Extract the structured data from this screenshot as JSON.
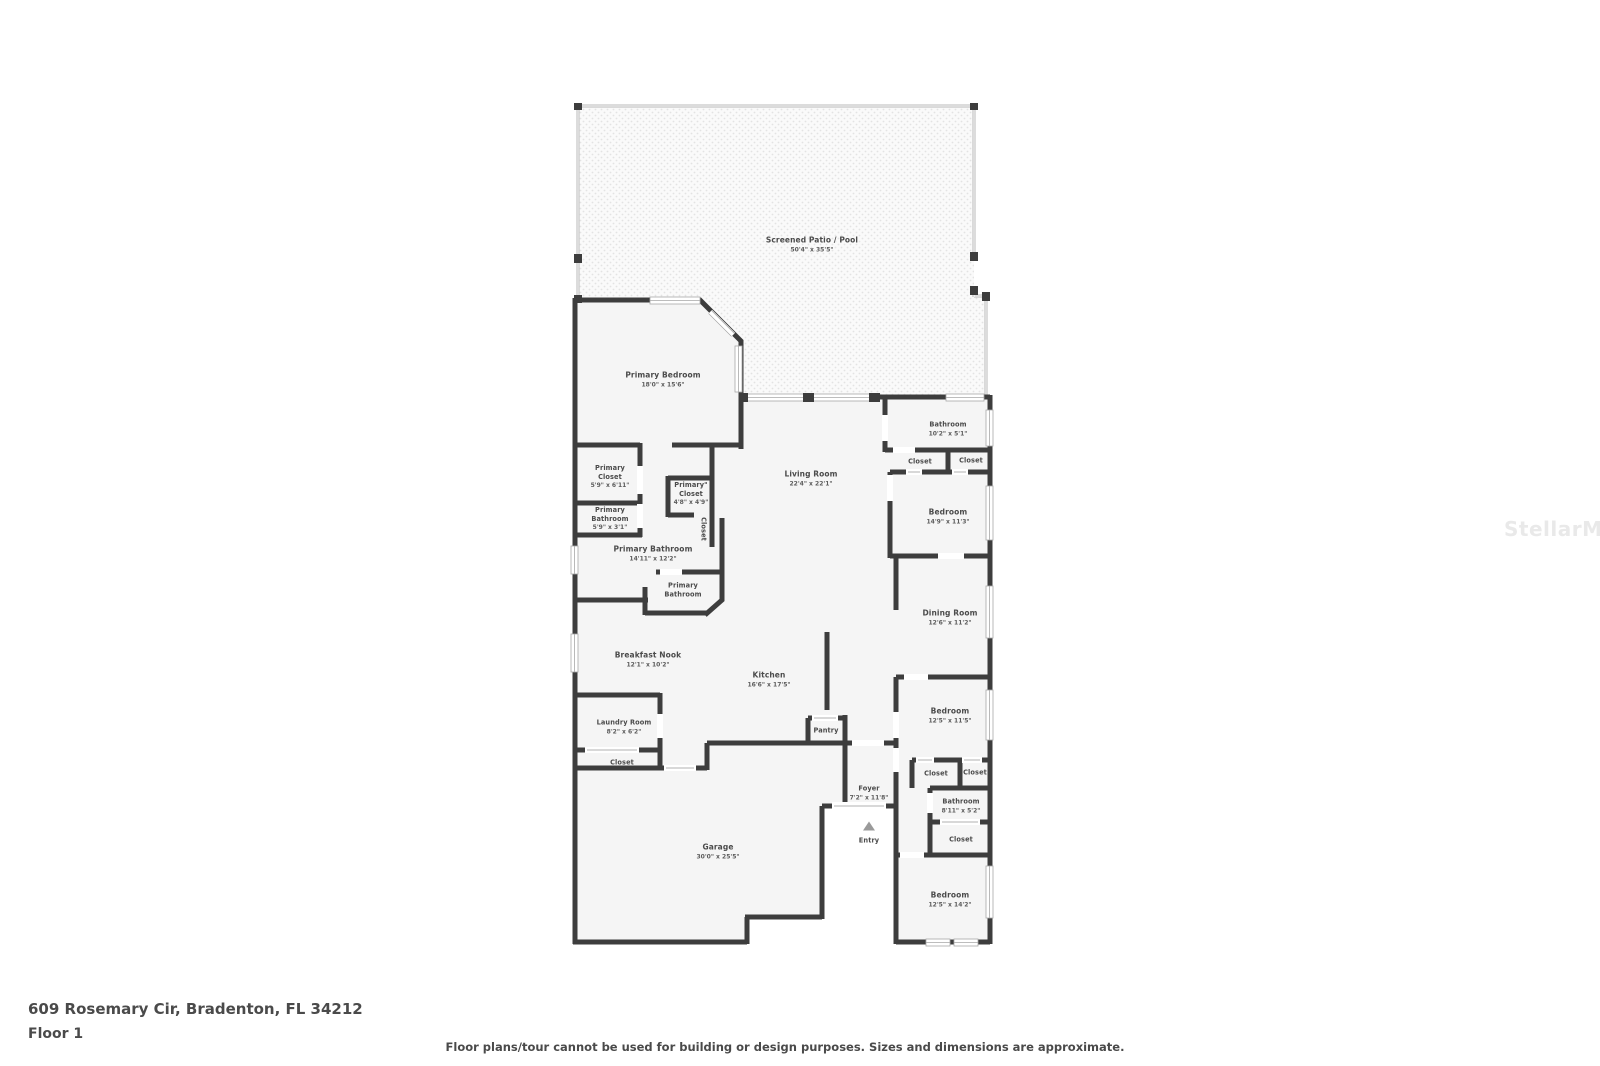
{
  "address": "609 Rosemary Cir, Bradenton, FL 34212",
  "floor_label": "Floor 1",
  "disclaimer": "Floor plans/tour cannot be used for building or design purposes. Sizes and dimensions are approximate.",
  "watermark": "StellarMLS",
  "colors": {
    "wall": "#3d3d3d",
    "room_fill": "#f5f5f5",
    "label_text": "#4b4b4b",
    "watermark": "#e9e9e9"
  },
  "rooms": [
    {
      "label": "Screened Patio / Pool",
      "dims": "50'4\" x 35'5\""
    },
    {
      "label": "Primary Bedroom",
      "dims": "18'0\" x 15'6\""
    },
    {
      "label": "Bathroom",
      "dims": "10'2\" x 5'1\""
    },
    {
      "label": "Closet",
      "dims": ""
    },
    {
      "label": "Closet",
      "dims": ""
    },
    {
      "label": "Primary\nCloset",
      "dims": "5'9\" x 6'11\""
    },
    {
      "label": "Primary\"\nCloset",
      "dims": "4'8\" x 4'9\""
    },
    {
      "label": "Closet",
      "dims": ""
    },
    {
      "label": "Primary\nBathroom",
      "dims": "5'9\" x 3'1\""
    },
    {
      "label": "Living Room",
      "dims": "22'4\" x 22'1\""
    },
    {
      "label": "Bedroom",
      "dims": "14'9\" x 11'3\""
    },
    {
      "label": "Primary Bathroom",
      "dims": "14'11\" x 12'2\""
    },
    {
      "label": "Primary\nBathroom",
      "dims": ""
    },
    {
      "label": "Dining Room",
      "dims": "12'6\" x 11'2\""
    },
    {
      "label": "Breakfast Nook",
      "dims": "12'1\" x 10'2\""
    },
    {
      "label": "Kitchen",
      "dims": "16'6\" x 17'5\""
    },
    {
      "label": "Laundry Room",
      "dims": "8'2\" x 6'2\""
    },
    {
      "label": "Closet",
      "dims": ""
    },
    {
      "label": "Pantry",
      "dims": ""
    },
    {
      "label": "Bedroom",
      "dims": "12'5\" x 11'5\""
    },
    {
      "label": "Closet",
      "dims": ""
    },
    {
      "label": "Closet",
      "dims": ""
    },
    {
      "label": "Foyer",
      "dims": "7'2\" x 11'8\""
    },
    {
      "label": "Bathroom",
      "dims": "8'11\" x 5'2\""
    },
    {
      "label": "Closet",
      "dims": ""
    },
    {
      "label": "Entry",
      "dims": ""
    },
    {
      "label": "Garage",
      "dims": "30'0\" x 25'5\""
    },
    {
      "label": "Bedroom",
      "dims": "12'5\" x 14'2\""
    }
  ]
}
